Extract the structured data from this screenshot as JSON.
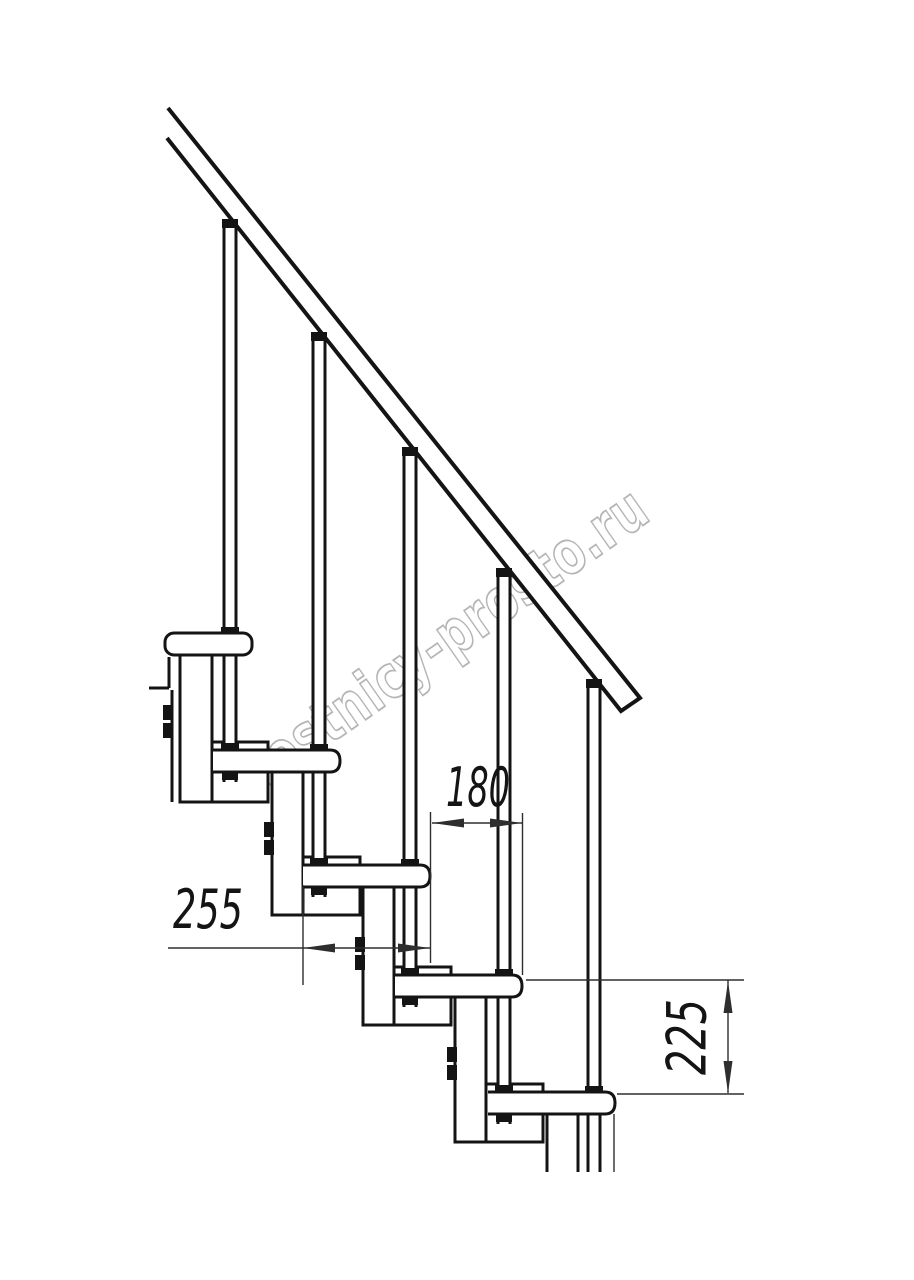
{
  "watermark": {
    "text": "lestnicy-prosto.ru"
  },
  "dimensions": {
    "step_run": {
      "label": "180"
    },
    "tread_depth": {
      "label": "255"
    },
    "step_rise": {
      "label": "225"
    }
  },
  "colors": {
    "background": "#ffffff",
    "line": "#141414",
    "dimension": "#2e2e2e",
    "watermark_outline": "#b5b5b5"
  }
}
